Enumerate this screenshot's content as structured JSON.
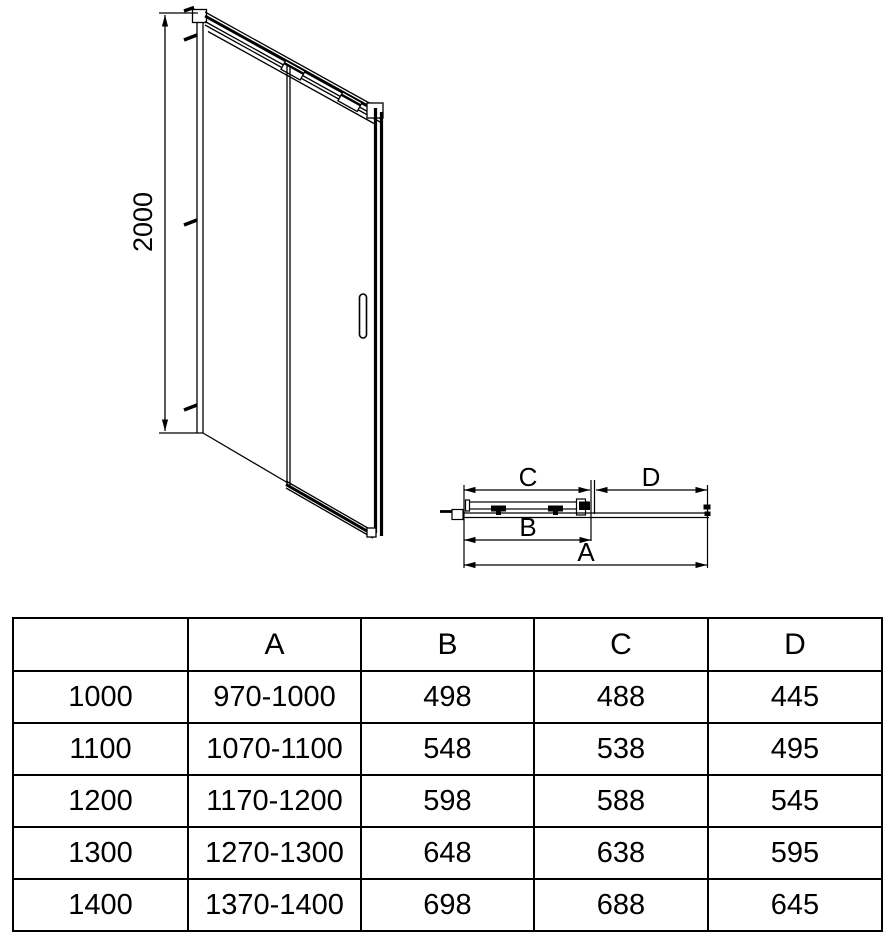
{
  "figure": {
    "front_view": {
      "height_dimension": "2000"
    },
    "top_view": {
      "dim_a": "A",
      "dim_b": "B",
      "dim_c": "C",
      "dim_d": "D"
    }
  },
  "size_table": {
    "columns": [
      "",
      "A",
      "B",
      "C",
      "D"
    ],
    "rows": [
      [
        "1000",
        "970-1000",
        "498",
        "488",
        "445"
      ],
      [
        "1100",
        "1070-1100",
        "548",
        "538",
        "495"
      ],
      [
        "1200",
        "1170-1200",
        "598",
        "588",
        "545"
      ],
      [
        "1300",
        "1270-1300",
        "648",
        "638",
        "595"
      ],
      [
        "1400",
        "1370-1400",
        "698",
        "688",
        "645"
      ]
    ]
  },
  "colors": {
    "line": "#000000",
    "background": "#ffffff",
    "text": "#000000"
  }
}
